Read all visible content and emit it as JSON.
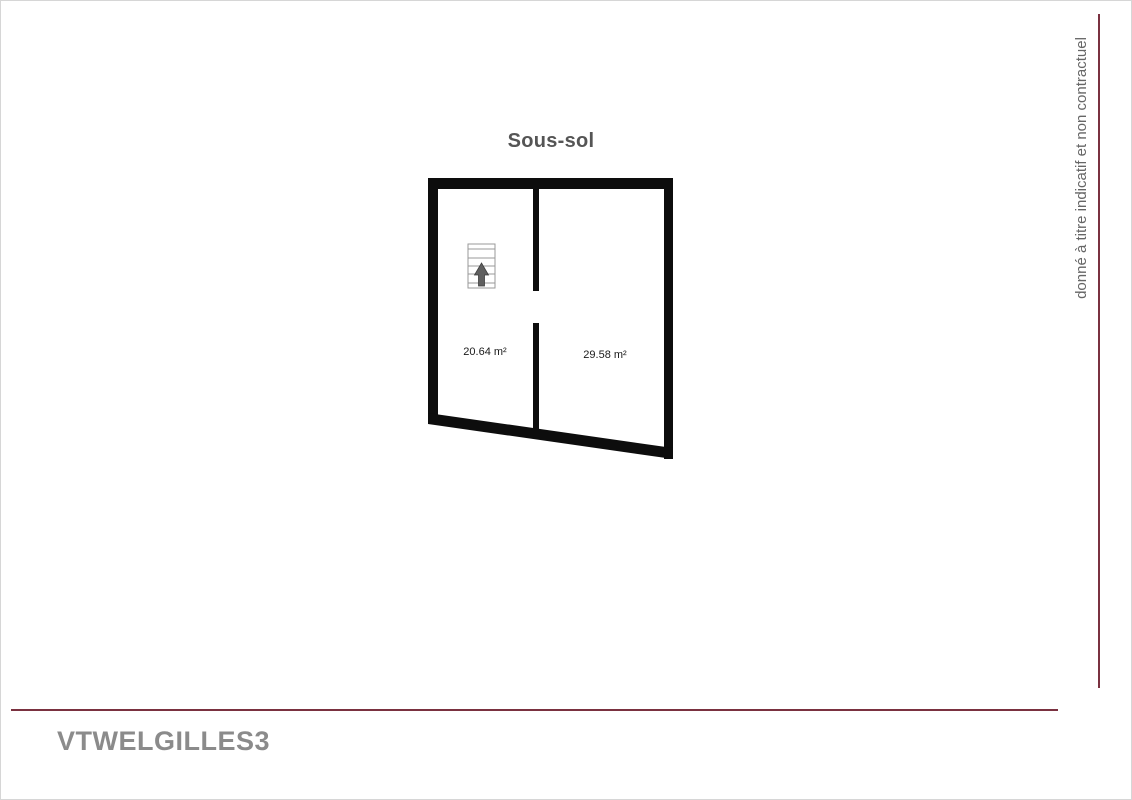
{
  "header": {
    "title": "Sous-sol"
  },
  "plan": {
    "rooms": [
      {
        "area_label": "20.64 m²"
      },
      {
        "area_label": "29.58 m²"
      }
    ],
    "stairs_icon": "stairs-with-up-arrow"
  },
  "sidebar_note": {
    "text": "donné à titre indicatif et non contractuel"
  },
  "footer": {
    "reference": "VTWELGILLES3"
  },
  "colors": {
    "accent_line": "#7a3140",
    "walls": "#0d0d0d",
    "title_text": "#555555",
    "note_text": "#666666",
    "watermark_text": "#8b8b8b"
  }
}
